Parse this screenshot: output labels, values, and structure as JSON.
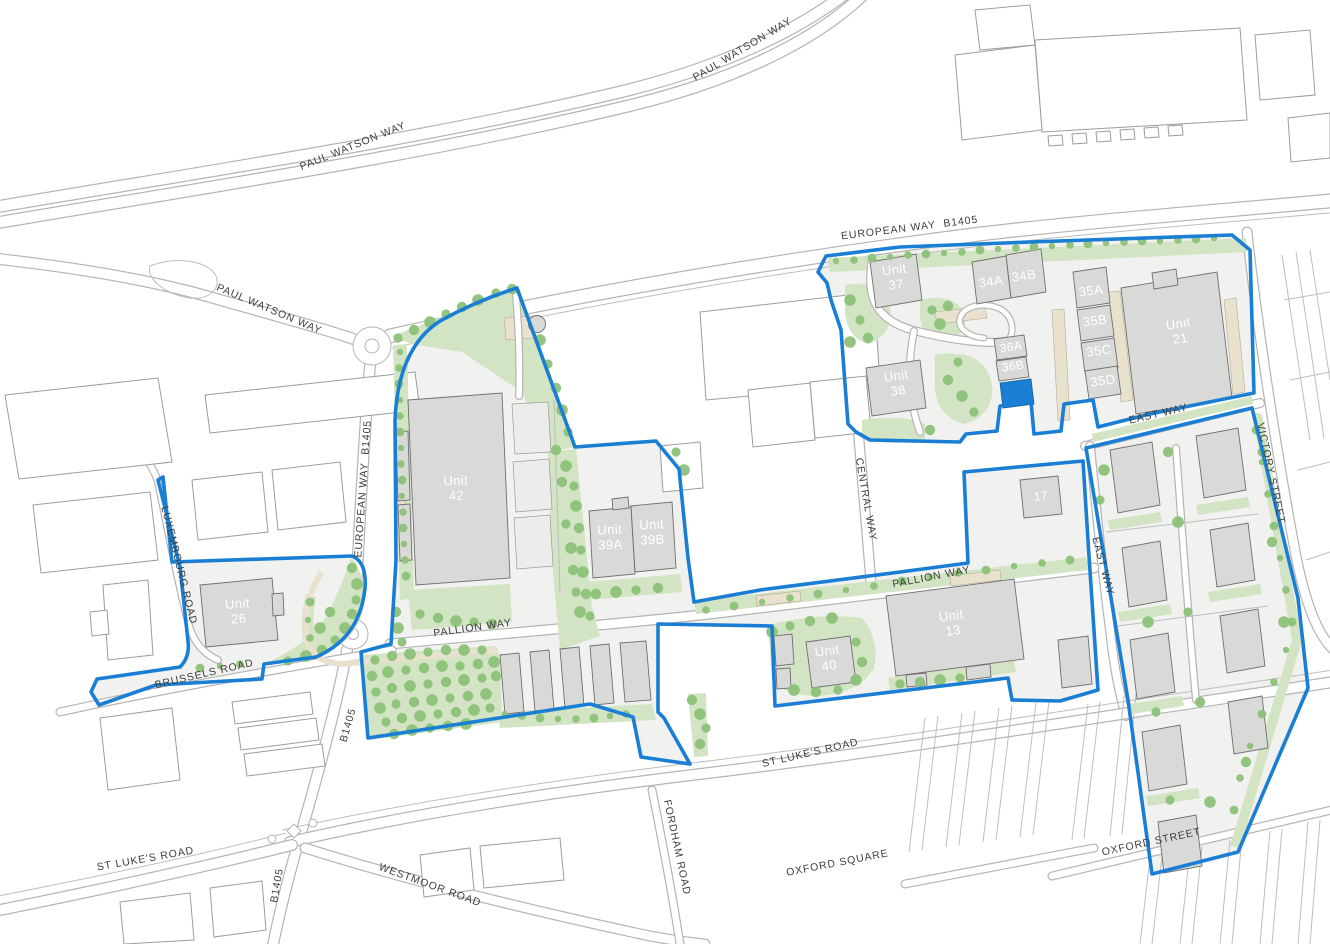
{
  "map": {
    "road_labels": [
      {
        "id": "paul-watson-way-ne",
        "text": "PAUL WATSON WAY"
      },
      {
        "id": "paul-watson-way-nw",
        "text": "PAUL WATSON WAY"
      },
      {
        "id": "paul-watson-way-w",
        "text": "PAUL WATSON WAY"
      },
      {
        "id": "european-way-b1405-top",
        "text": "EUROPEAN WAY  B1405"
      },
      {
        "id": "european-way-b1405-west",
        "text": "EUROPEAN WAY  B1405"
      },
      {
        "id": "b1405-mid",
        "text": "B1405"
      },
      {
        "id": "b1405-south",
        "text": "B1405"
      },
      {
        "id": "luxembourg-road",
        "text": "LUXEMBOURG ROAD"
      },
      {
        "id": "brussels-road",
        "text": "BRUSSELS ROAD"
      },
      {
        "id": "pallion-way-west",
        "text": "PALLION WAY"
      },
      {
        "id": "pallion-way-east",
        "text": "PALLION WAY"
      },
      {
        "id": "central-way",
        "text": "CENTRAL WAY"
      },
      {
        "id": "east-way-south",
        "text": "EAST WAY"
      },
      {
        "id": "east-way-vertical",
        "text": "EAST WAY"
      },
      {
        "id": "victory-street",
        "text": "VICTORY STREET"
      },
      {
        "id": "st-lukes-road-mid",
        "text": "ST LUKE'S ROAD"
      },
      {
        "id": "st-lukes-road-west",
        "text": "ST LUKE'S ROAD"
      },
      {
        "id": "fordham-road",
        "text": "FORDHAM ROAD"
      },
      {
        "id": "westmoor-road",
        "text": "WESTMOOR ROAD"
      },
      {
        "id": "oxford-square",
        "text": "OXFORD SQUARE"
      },
      {
        "id": "oxford-street",
        "text": "OXFORD STREET"
      }
    ],
    "units": [
      {
        "id": "unit-42",
        "lines": [
          "Unit",
          "42"
        ]
      },
      {
        "id": "unit-39a",
        "lines": [
          "Unit",
          "39A"
        ]
      },
      {
        "id": "unit-39b",
        "lines": [
          "Unit",
          "39B"
        ]
      },
      {
        "id": "unit-26",
        "lines": [
          "Unit",
          "26"
        ]
      },
      {
        "id": "unit-37",
        "lines": [
          "Unit",
          "37"
        ]
      },
      {
        "id": "unit-38",
        "lines": [
          "Unit",
          "38"
        ]
      },
      {
        "id": "unit-34a",
        "lines": [
          "34A"
        ]
      },
      {
        "id": "unit-34b",
        "lines": [
          "34B"
        ]
      },
      {
        "id": "unit-35a",
        "lines": [
          "35A"
        ]
      },
      {
        "id": "unit-35b",
        "lines": [
          "35B"
        ]
      },
      {
        "id": "unit-35c",
        "lines": [
          "35C"
        ]
      },
      {
        "id": "unit-35d",
        "lines": [
          "35D"
        ]
      },
      {
        "id": "unit-36a",
        "lines": [
          "36A"
        ]
      },
      {
        "id": "unit-36b",
        "lines": [
          "36B"
        ]
      },
      {
        "id": "unit-21",
        "lines": [
          "Unit",
          "21"
        ]
      },
      {
        "id": "unit-13",
        "lines": [
          "Unit",
          "13"
        ]
      },
      {
        "id": "unit-40",
        "lines": [
          "Unit",
          "40"
        ]
      },
      {
        "id": "unit-17",
        "lines": [
          "17"
        ]
      }
    ],
    "colors": {
      "boundary": "#1a7fd4",
      "highlighted_unit": "#1a7fd4",
      "green_area": "#d2e4c3",
      "tree": "#8cc178",
      "building_fill": "#d9dad8",
      "building_stroke": "#6f6f6f",
      "parcel_ground": "#f1f1ef",
      "surface_beige": "#e8e1cd",
      "road_line": "#b4b4b4",
      "label_text": "#3d3d3d",
      "unit_text": "#ffffff"
    }
  }
}
